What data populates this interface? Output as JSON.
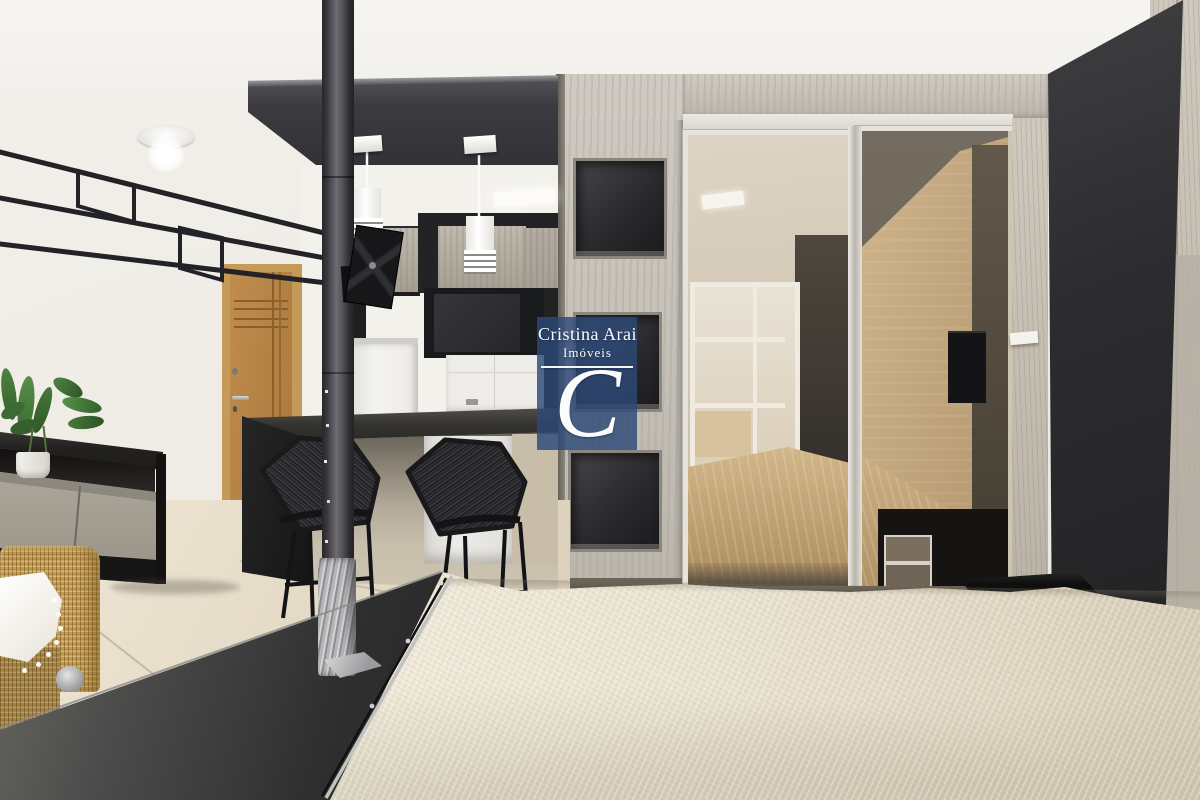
{
  "watermark": {
    "title": "Cristina Arai",
    "subtitle": "Imóveis",
    "monogram": "C",
    "brand_blue_rgba": "rgba(45,73,120,0.82)",
    "text_color": "#fbfbfb"
  },
  "palette": {
    "wall_white": "#efece6",
    "ceiling_white": "#f5f3f0",
    "soffit_black": "#3a3a3f",
    "concrete_gray": "#c6c1b8",
    "door_oak": "#b8813f",
    "counter_black": "#2b2a28",
    "bench_gray": "#3c3c3d",
    "quilt_cream": "#e9e2d2",
    "floor_beige": "#e4dbc8",
    "wicker_gold": "#c09a52",
    "mirror_bronze": "#d2c6b2",
    "black_wall": "#2e2e30",
    "bed_reflection_tan": "#c2a678"
  },
  "scene": {
    "description": "Studio apartment photo: kitchen bar with two wire stools, black structural pole, niche divider column, mirrored sliding wardrobe reflecting a bed, cream quilt bed in foreground, sideboard, plant and wicker chair on the left",
    "objects": [
      "ceiling-lamp",
      "wall-rail",
      "entry-door",
      "pendant-lights",
      "kitchen-cabinets",
      "fridge",
      "tv-mount",
      "bar-counter",
      "bar-stools",
      "structural-pole",
      "niche-column",
      "mirror-wardrobe",
      "bed-reflection",
      "black-accent-wall",
      "sideboard",
      "potted-plant",
      "wicker-chair",
      "white-throw",
      "foot-bench",
      "bed-quilt",
      "nightstand"
    ]
  }
}
